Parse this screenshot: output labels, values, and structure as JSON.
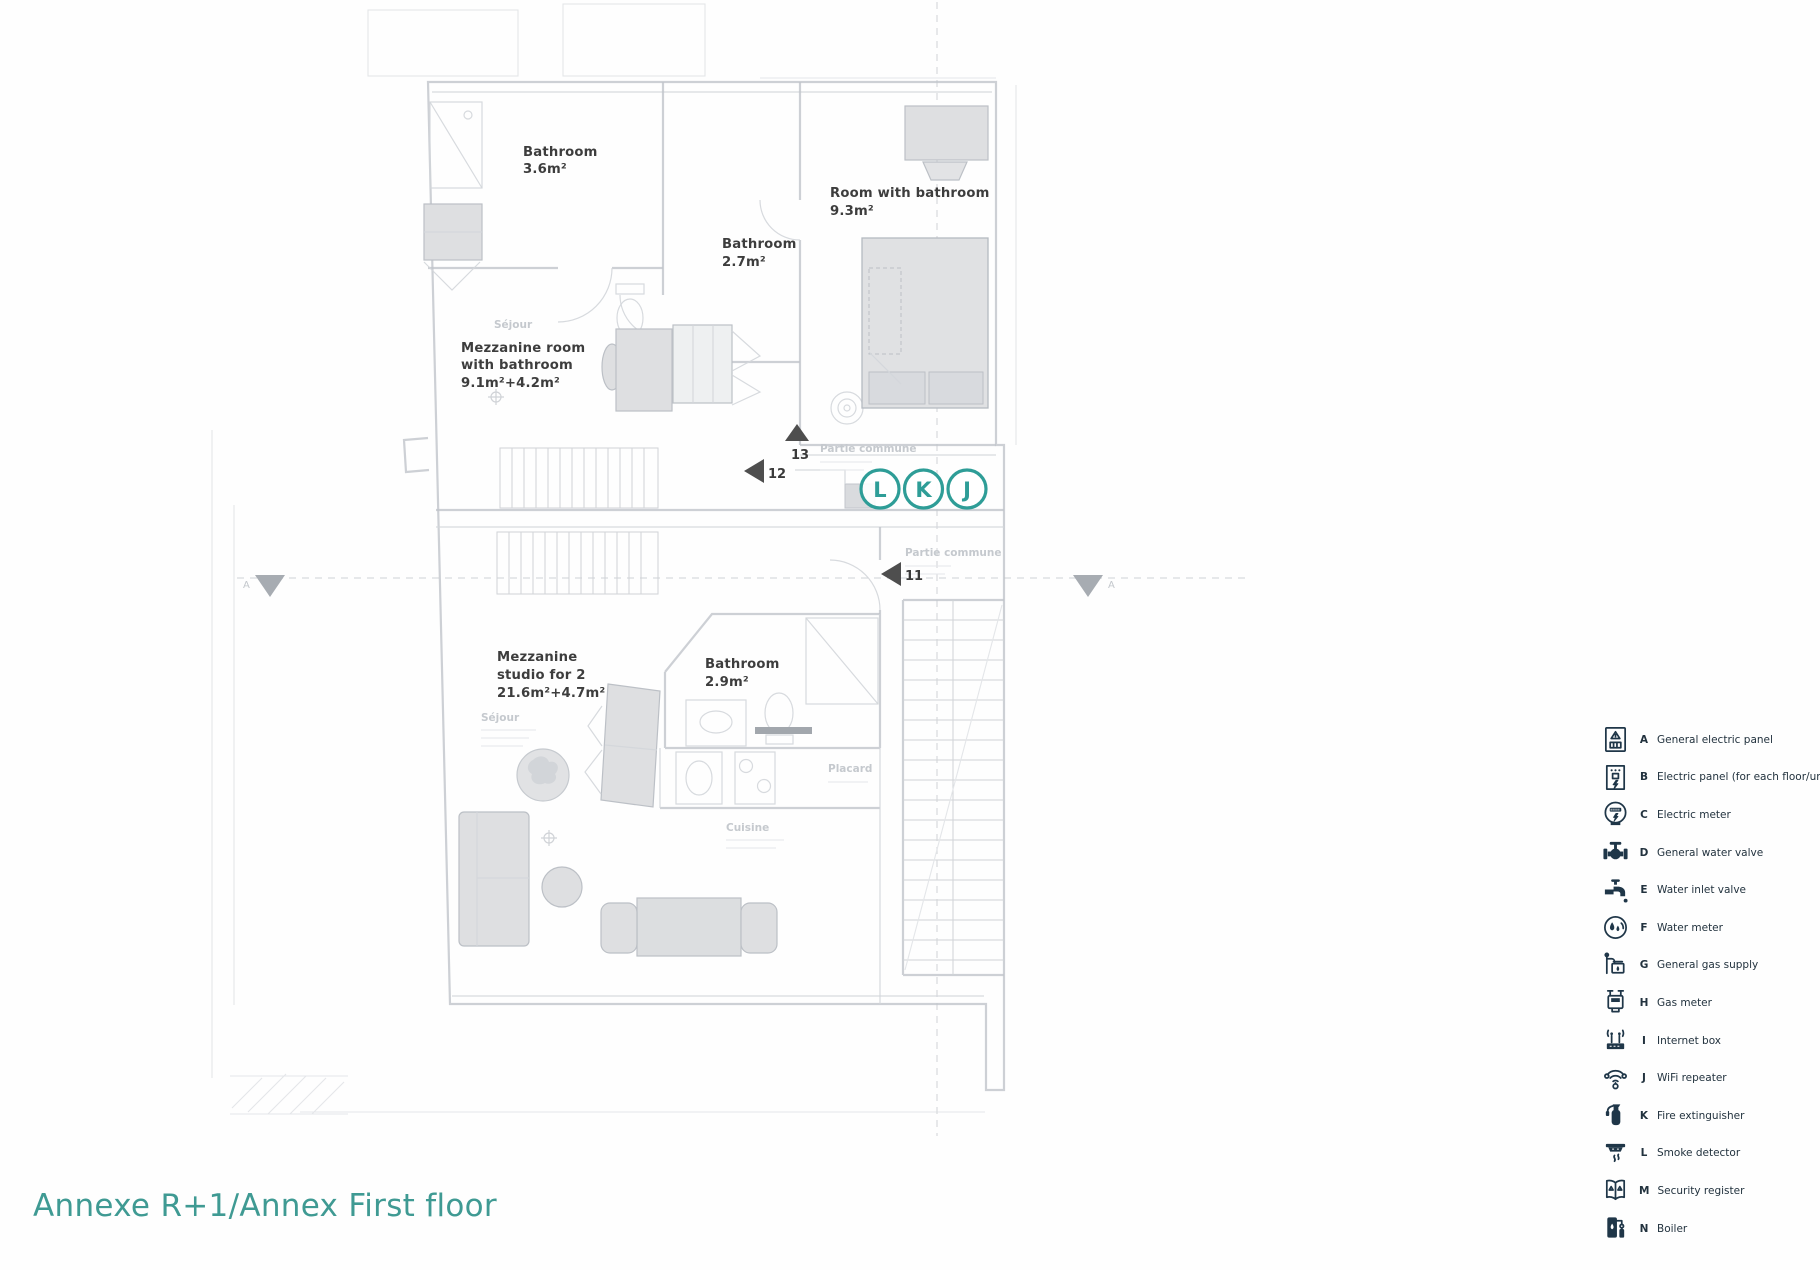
{
  "document": {
    "title": "Annexe R+1/Annex First floor",
    "title_color": "#3f9a93"
  },
  "plan": {
    "accent_color": "#2e9d97",
    "rooms": [
      {
        "name": "bathroom-upper-left",
        "lines": [
          "Bathroom",
          "3.6m²"
        ]
      },
      {
        "name": "bathroom-upper-middle",
        "lines": [
          "Bathroom",
          "2.7m²"
        ]
      },
      {
        "name": "room-with-bathroom",
        "lines": [
          "Room with bathroom",
          "9.3m²"
        ]
      },
      {
        "name": "mezzanine-room",
        "lines": [
          "Mezzanine room",
          "with bathroom",
          "9.1m²+4.2m²"
        ]
      },
      {
        "name": "mezzanine-studio",
        "lines": [
          "Mezzanine",
          "studio for 2",
          "21.6m²+4.7m²"
        ]
      },
      {
        "name": "bathroom-lower",
        "lines": [
          "Bathroom",
          "2.9m²"
        ]
      }
    ],
    "device_markers": [
      {
        "letter": "L"
      },
      {
        "letter": "K"
      },
      {
        "letter": "J"
      }
    ],
    "position_markers": [
      {
        "number": "13"
      },
      {
        "number": "12"
      },
      {
        "number": "11"
      }
    ],
    "section_label": "A",
    "faint_labels": [
      "Partie commune",
      "Partie commune",
      "Séjour",
      "Séjour",
      "Cuisine",
      "Placard"
    ]
  },
  "legend": {
    "icon_color": "#1f3648",
    "items": [
      {
        "letter": "A",
        "label": "General electric panel"
      },
      {
        "letter": "B",
        "label": "Electric panel (for each floor/unit)"
      },
      {
        "letter": "C",
        "label": "Electric meter"
      },
      {
        "letter": "D",
        "label": "General water valve"
      },
      {
        "letter": "E",
        "label": "Water inlet valve"
      },
      {
        "letter": "F",
        "label": "Water meter"
      },
      {
        "letter": "G",
        "label": "General gas supply"
      },
      {
        "letter": "H",
        "label": "Gas meter"
      },
      {
        "letter": "I",
        "label": "Internet box"
      },
      {
        "letter": "J",
        "label": "WiFi repeater"
      },
      {
        "letter": "K",
        "label": "Fire extinguisher"
      },
      {
        "letter": "L",
        "label": "Smoke detector"
      },
      {
        "letter": "M",
        "label": "Security register"
      },
      {
        "letter": "N",
        "label": "Boiler"
      }
    ]
  }
}
